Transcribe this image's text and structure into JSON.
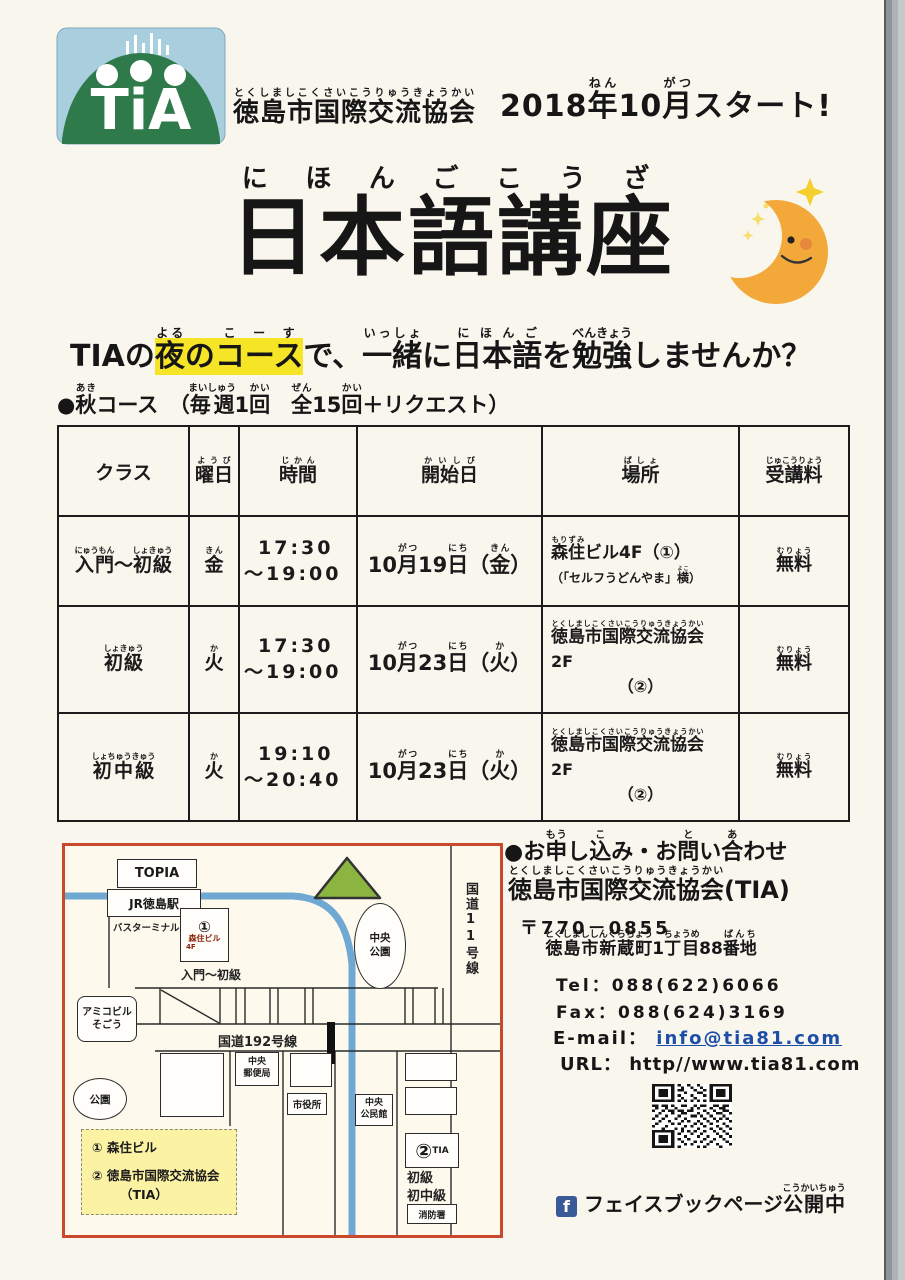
{
  "header": {
    "org": [
      {
        "t": "徳島市国際交流協会",
        "r": "とくしましこくさいこうりゅうきょうかい"
      }
    ],
    "start": [
      {
        "t": "2018"
      },
      {
        "t": "年",
        "r": "ねん"
      },
      {
        "t": "10"
      },
      {
        "t": "月",
        "r": "がつ"
      },
      {
        "t": "スタート!"
      }
    ]
  },
  "title": {
    "main": [
      {
        "t": "日本語講座",
        "r": "にほんごこうざ"
      }
    ]
  },
  "tagline": [
    {
      "t": "TIAの"
    },
    {
      "t": "夜",
      "r": "よる",
      "hl": true
    },
    {
      "t": "の",
      "hl": true
    },
    {
      "t": "コース",
      "r": "こーす",
      "hl": true
    },
    {
      "t": "で、"
    },
    {
      "t": "一緒",
      "r": "いっしょ"
    },
    {
      "t": "に"
    },
    {
      "t": "日本語",
      "r": "にほんご"
    },
    {
      "t": "を"
    },
    {
      "t": "勉強",
      "r": "べんきょう"
    },
    {
      "t": "しませんか？"
    }
  ],
  "course_line": [
    {
      "t": "●"
    },
    {
      "t": "秋",
      "r": "あき"
    },
    {
      "t": "コース　（"
    },
    {
      "t": "毎週",
      "r": "まいしゅう"
    },
    {
      "t": "1"
    },
    {
      "t": "回",
      "r": "かい"
    },
    {
      "t": "　"
    },
    {
      "t": "全",
      "r": "ぜん"
    },
    {
      "t": "15"
    },
    {
      "t": "回",
      "r": "かい"
    },
    {
      "t": "＋リクエスト）"
    }
  ],
  "table": {
    "headers": [
      [
        {
          "t": "クラス"
        }
      ],
      [
        {
          "t": "曜日",
          "r": "ようび"
        }
      ],
      [
        {
          "t": "時間",
          "r": "じかん"
        }
      ],
      [
        {
          "t": "開始日",
          "r": "かいしび"
        }
      ],
      [
        {
          "t": "場所",
          "r": "ばしょ"
        }
      ],
      [
        {
          "t": "受講料",
          "r": "じゅこうりょう"
        }
      ]
    ],
    "rows": [
      {
        "class": [
          {
            "t": "入門",
            "r": "にゅうもん"
          },
          {
            "t": "～"
          },
          {
            "t": "初級",
            "r": "しょきゅう"
          }
        ],
        "day": [
          {
            "t": "金",
            "r": "きん"
          }
        ],
        "time1": "17:30",
        "time2": "～19:00",
        "date": [
          {
            "t": "10"
          },
          {
            "t": "月",
            "r": "がつ"
          },
          {
            "t": "19"
          },
          {
            "t": "日",
            "r": "にち"
          },
          {
            "t": "（"
          },
          {
            "t": "金",
            "r": "きん"
          },
          {
            "t": "）"
          }
        ],
        "place_l1": [
          {
            "t": "森住",
            "r": "もりずみ"
          },
          {
            "t": "ビル4F（①）"
          }
        ],
        "place_l2": [
          {
            "t": "（「セルフうどんやま」"
          },
          {
            "t": "横",
            "r": "よこ"
          },
          {
            "t": "）"
          }
        ],
        "fee": [
          {
            "t": "無料",
            "r": "むりょう"
          }
        ]
      },
      {
        "class": [
          {
            "t": "初級",
            "r": "しょきゅう"
          }
        ],
        "day": [
          {
            "t": "火",
            "r": "か"
          }
        ],
        "time1": "17:30",
        "time2": "～19:00",
        "date": [
          {
            "t": "10"
          },
          {
            "t": "月",
            "r": "がつ"
          },
          {
            "t": "23"
          },
          {
            "t": "日",
            "r": "にち"
          },
          {
            "t": "（"
          },
          {
            "t": "火",
            "r": "か"
          },
          {
            "t": "）"
          }
        ],
        "place_l1": [
          {
            "t": "徳島市国際交流協会",
            "r": "とくしましこくさいこうりゅうきょうかい"
          }
        ],
        "place_l2": "2F",
        "place_l3": "（②）",
        "fee": [
          {
            "t": "無料",
            "r": "むりょう"
          }
        ]
      },
      {
        "class": [
          {
            "t": "初中級",
            "r": "しょちゅうきゅう"
          }
        ],
        "day": [
          {
            "t": "火",
            "r": "か"
          }
        ],
        "time1": "19:10",
        "time2": "～20:40",
        "date": [
          {
            "t": "10"
          },
          {
            "t": "月",
            "r": "がつ"
          },
          {
            "t": "23"
          },
          {
            "t": "日",
            "r": "にち"
          },
          {
            "t": "（"
          },
          {
            "t": "火",
            "r": "か"
          },
          {
            "t": "）"
          }
        ],
        "place_l1": [
          {
            "t": "徳島市国際交流協会",
            "r": "とくしましこくさいこうりゅうきょうかい"
          }
        ],
        "place_l2": "2F",
        "place_l3": "（②）",
        "fee": [
          {
            "t": "無料",
            "r": "むりょう"
          }
        ]
      }
    ]
  },
  "map": {
    "topia": "TOPIA",
    "jr_station": "JR徳島駅",
    "bus_terminal": "バスターミナル",
    "b1_no": "①",
    "b1_name": "森住ビル",
    "b1_floor": "4F",
    "b1_class": "入門～初級",
    "amico_l1": "アミコビル",
    "amico_l2": "そごう",
    "park_central_l1": "中央",
    "park_central_l2": "公園",
    "route11": "国道11号線",
    "route192": "国道192号線",
    "park": "公園",
    "post_l1": "中央",
    "post_l2": "郵便局",
    "city_hall": "市役所",
    "kominkan_l1": "中央",
    "kominkan_l2": "公民館",
    "legend_1": "① 森住ビル",
    "legend_2": "② 徳島市国際交流協会",
    "legend_2b": "（TIA）",
    "b2_no": "②",
    "b2_name": "TIA",
    "b2_class_l1": "初級",
    "b2_class_l2": "初中級",
    "fire": "消防署"
  },
  "contact": {
    "heading": [
      {
        "t": "●お"
      },
      {
        "t": "申",
        "r": "もう"
      },
      {
        "t": "し"
      },
      {
        "t": "込",
        "r": "こ"
      },
      {
        "t": "み・お"
      },
      {
        "t": "問",
        "r": "と"
      },
      {
        "t": "い"
      },
      {
        "t": "合",
        "r": "あ"
      },
      {
        "t": "わせ"
      }
    ],
    "org": [
      {
        "t": "徳島市国際交流協会",
        "r": "とくしましこくさいこうりゅうきょうかい"
      },
      {
        "t": "(TIA)"
      }
    ],
    "postal": "〒770－0855",
    "address": [
      {
        "t": "徳島市新蔵町",
        "r": "とくしまししんくらちょう"
      },
      {
        "t": "1"
      },
      {
        "t": "丁目",
        "r": "ちょうめ"
      },
      {
        "t": "88"
      },
      {
        "t": "番地",
        "r": "ばんち"
      }
    ],
    "tel": "Tel：088(622)6066",
    "fax": "Fax：088(624)3169",
    "email_label": "E-mail：",
    "email": "info@tia81.com",
    "url_label": "URL：",
    "url": "http//www.tia81.com",
    "facebook_f": "f",
    "facebook": [
      {
        "t": "フェイスブックページ"
      },
      {
        "t": "公開中",
        "r": "こうかいちゅう"
      }
    ]
  },
  "colors": {
    "highlight": "#f6e527",
    "map_border": "#c8492b",
    "route_blue": "#6fa8d2",
    "park_green": "#8cb441",
    "link_blue": "#1d4fa8",
    "facebook_blue": "#3a5a97",
    "logo_green": "#2f7a4b",
    "logo_sky": "#a9cede",
    "moon_orange": "#f3a93a"
  }
}
